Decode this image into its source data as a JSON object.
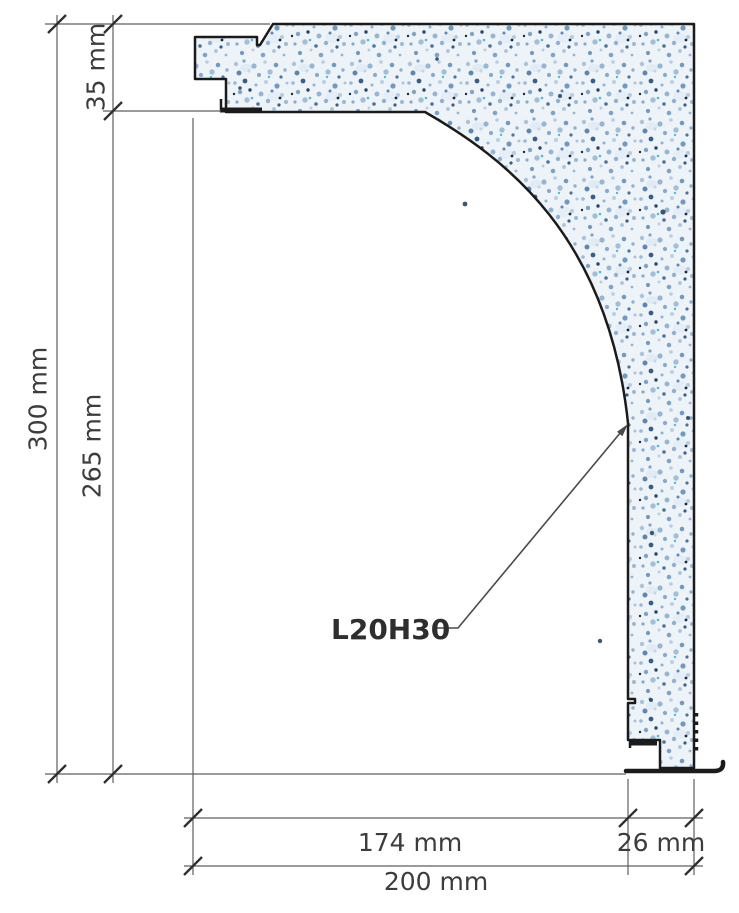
{
  "product": {
    "code_label": "L20H30"
  },
  "dimensions": {
    "overall_height": "300 mm",
    "top_height": "35 mm",
    "inner_height": "265 mm",
    "inner_width": "174 mm",
    "leg_width": "26 mm",
    "overall_width": "200 mm"
  },
  "colors": {
    "outline": "#1b1b1b",
    "dimension_line": "#5f5f5f",
    "tick": "#2f2f2f",
    "dimension_text": "#3c3c3c",
    "leader_line": "#4a4a4a",
    "foam_base": "#eef3f8",
    "foam_speckle_light": "#a9c4de",
    "foam_speckle_mid": "#7da5c9",
    "foam_speckle_dark": "#345f8c",
    "foam_speckle_deepest": "#17293f",
    "foam_accent_teal": "#3fc0d8"
  }
}
